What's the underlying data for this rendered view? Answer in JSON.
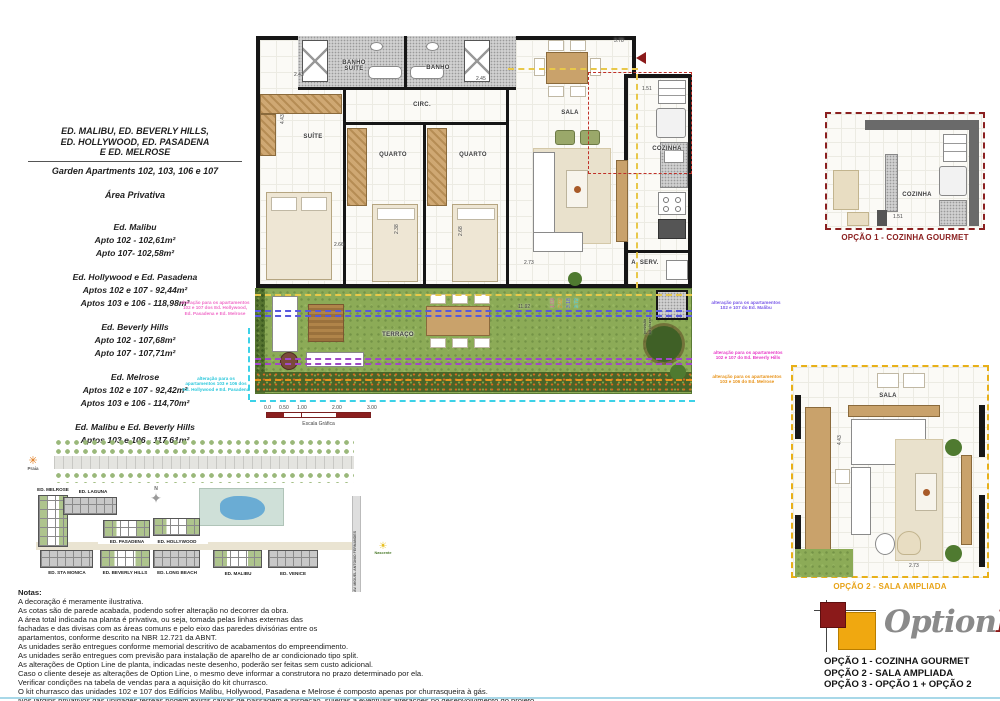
{
  "info_panel": {
    "title1": "ED. MALIBU, ED. BEVERLY HILLS,",
    "title2": "ED. HOLLYWOOD, ED. PASADENA",
    "title3": "E ED. MELROSE",
    "subtitle": "Garden Apartments 102, 103, 106 e 107",
    "section": "Área Privativa",
    "groups": [
      {
        "name": "Ed. Malibu",
        "l0": "Apto 102 - 102,61m²",
        "l1": "Apto 107- 102,58m²"
      },
      {
        "name": "Ed. Hollywood e Ed. Pasadena",
        "l0": "Aptos 102 e 107 - 92,44m²",
        "l1": "Aptos 103 e 106 - 118,98m²"
      },
      {
        "name": "Ed. Beverly Hills",
        "l0": "Apto 102 - 107,68m²",
        "l1": "Apto 107 - 107,71m²"
      },
      {
        "name": "Ed. Melrose",
        "l0": "Aptos 102 e 107 - 92,42m²",
        "l1": "Aptos 103 e 106 - 114,70m²"
      },
      {
        "name": "Ed. Malibu e Ed. Beverly Hills",
        "l0": "Aptos 103 e 106 - 117,61m²",
        "l1": ""
      }
    ]
  },
  "floor_plan": {
    "rooms": {
      "suite": "SUÍTE",
      "quarto1": "QUARTO",
      "quarto2": "QUARTO",
      "banho_suite": "BANHO\nSUÍTE",
      "banho": "BANHO",
      "circ": "CIRC.",
      "sala": "SALA",
      "cozinha": "COZINHA",
      "a_serv": "A. SERV.",
      "terraco": "TERRAÇO"
    },
    "dims": {
      "d243": "2.43",
      "d245": "2.45",
      "d378": "3.78",
      "d151": "1.51",
      "d443": "4.43",
      "d266": "2.66",
      "d238": "2.38",
      "d268": "2.68",
      "d273": "2.73",
      "d1192": "11.92",
      "d103": "1.03",
      "d292": "2.92",
      "d318": "3.18",
      "d372": "3.72"
    },
    "kit_note": "previsão\nkit churrasco"
  },
  "annotations": [
    {
      "text": "alteração para os apartamentos\n102 e 107 dos Ed. Hollywood,\nEd. Pasadena e Ed. Melrose",
      "color": "#f06ec8"
    },
    {
      "text": "alteração para os\napartamentos 103 e 106 dos\nEd. Hollywood e Ed. Pasadena",
      "color": "#2ec8dc"
    },
    {
      "text": "alteração para os apartamentos\n102 e 107 do Ed. Malibu",
      "color": "#7a5ae8"
    },
    {
      "text": "alteração para os apartamentos\n102 e 107 do Ed. Beverly Hills",
      "color": "#e83cc8"
    },
    {
      "text": "alteração para os apartamentos\n103 e 106 do Ed. Melrose",
      "color": "#e8941c"
    }
  ],
  "scale_bar": {
    "ticks": [
      "0.0",
      "0.50",
      "1.00",
      "2.00",
      "3.00"
    ],
    "label": "Escala Gráfica"
  },
  "site_plan": {
    "praia": "Praia",
    "nascente": "Nascente",
    "compass": "N",
    "street": "AV. MIGUEL ANTONIO FERNANDES",
    "buildings": [
      "ED. MELROSE",
      "ED. LAGUNA",
      "ED. PASADENA",
      "ED. HOLLYWOOD",
      "ED. STA MONICA",
      "ED. BEVERLY HILLS",
      "ED. LONG BEACH",
      "ED. MALIBU",
      "ED. VENICE"
    ]
  },
  "notes": {
    "heading": "Notas:",
    "lines": [
      "A decoração é meramente ilustrativa.",
      "As cotas são de parede acabada, podendo sofrer alteração no decorrer da obra.",
      "A área total indicada na planta é privativa, ou seja, tomada pelas linhas externas das",
      "fachadas e das divisas com as áreas comuns e pelo eixo das paredes divisórias entre os",
      "apartamentos, conforme descrito na NBR 12.721 da ABNT.",
      "As unidades serão entregues conforme memorial descritivo de acabamentos do empreendimento.",
      "As unidades serão entregues com previsão para instalação de aparelho de ar condicionado tipo split.",
      "As alterações de Option Line de planta, indicadas neste desenho, poderão ser feitas sem custo adicional.",
      "Caso o cliente deseje as alterações de Option Line, o mesmo deve informar a construtora no prazo determinado por ela.",
      "Verificar condições na tabela de vendas para a aquisição do kit churrasco.",
      "O kit churrasco das unidades 102 e 107 dos Edifícios Malibu, Hollywood, Pasadena e Melrose é composto apenas por churrasqueira à gás.",
      "Nos jardins privativos das unidades térreas podem existir caixas de passagem e inspeção, sujeitas a eventuais alterações no desenvolvimento do projeto."
    ]
  },
  "options": {
    "opt1_caption": "OPÇÃO 1 - COZINHA GOURMET",
    "opt2_caption": "OPÇÃO 2 - SALA AMPLIADA",
    "opt1_room": "COZINHA",
    "opt2_room": "SALA",
    "opt1_dim": "1.51",
    "opt2_dim_a": "4.43",
    "opt2_dim_b": "2.73",
    "logo_part1": "Option",
    "logo_part2": "Line",
    "list": [
      "OPÇÃO 1 - COZINHA GOURMET",
      "OPÇÃO 2 - SALA AMPLIADA",
      "OPÇÃO 3 - OPÇÃO 1 + OPÇÃO 2"
    ],
    "colors": {
      "opt1": "#8b2020",
      "opt2": "#e8a317",
      "logo_gray": "#8a8a8a",
      "logo_red": "#8b1a1a"
    }
  }
}
